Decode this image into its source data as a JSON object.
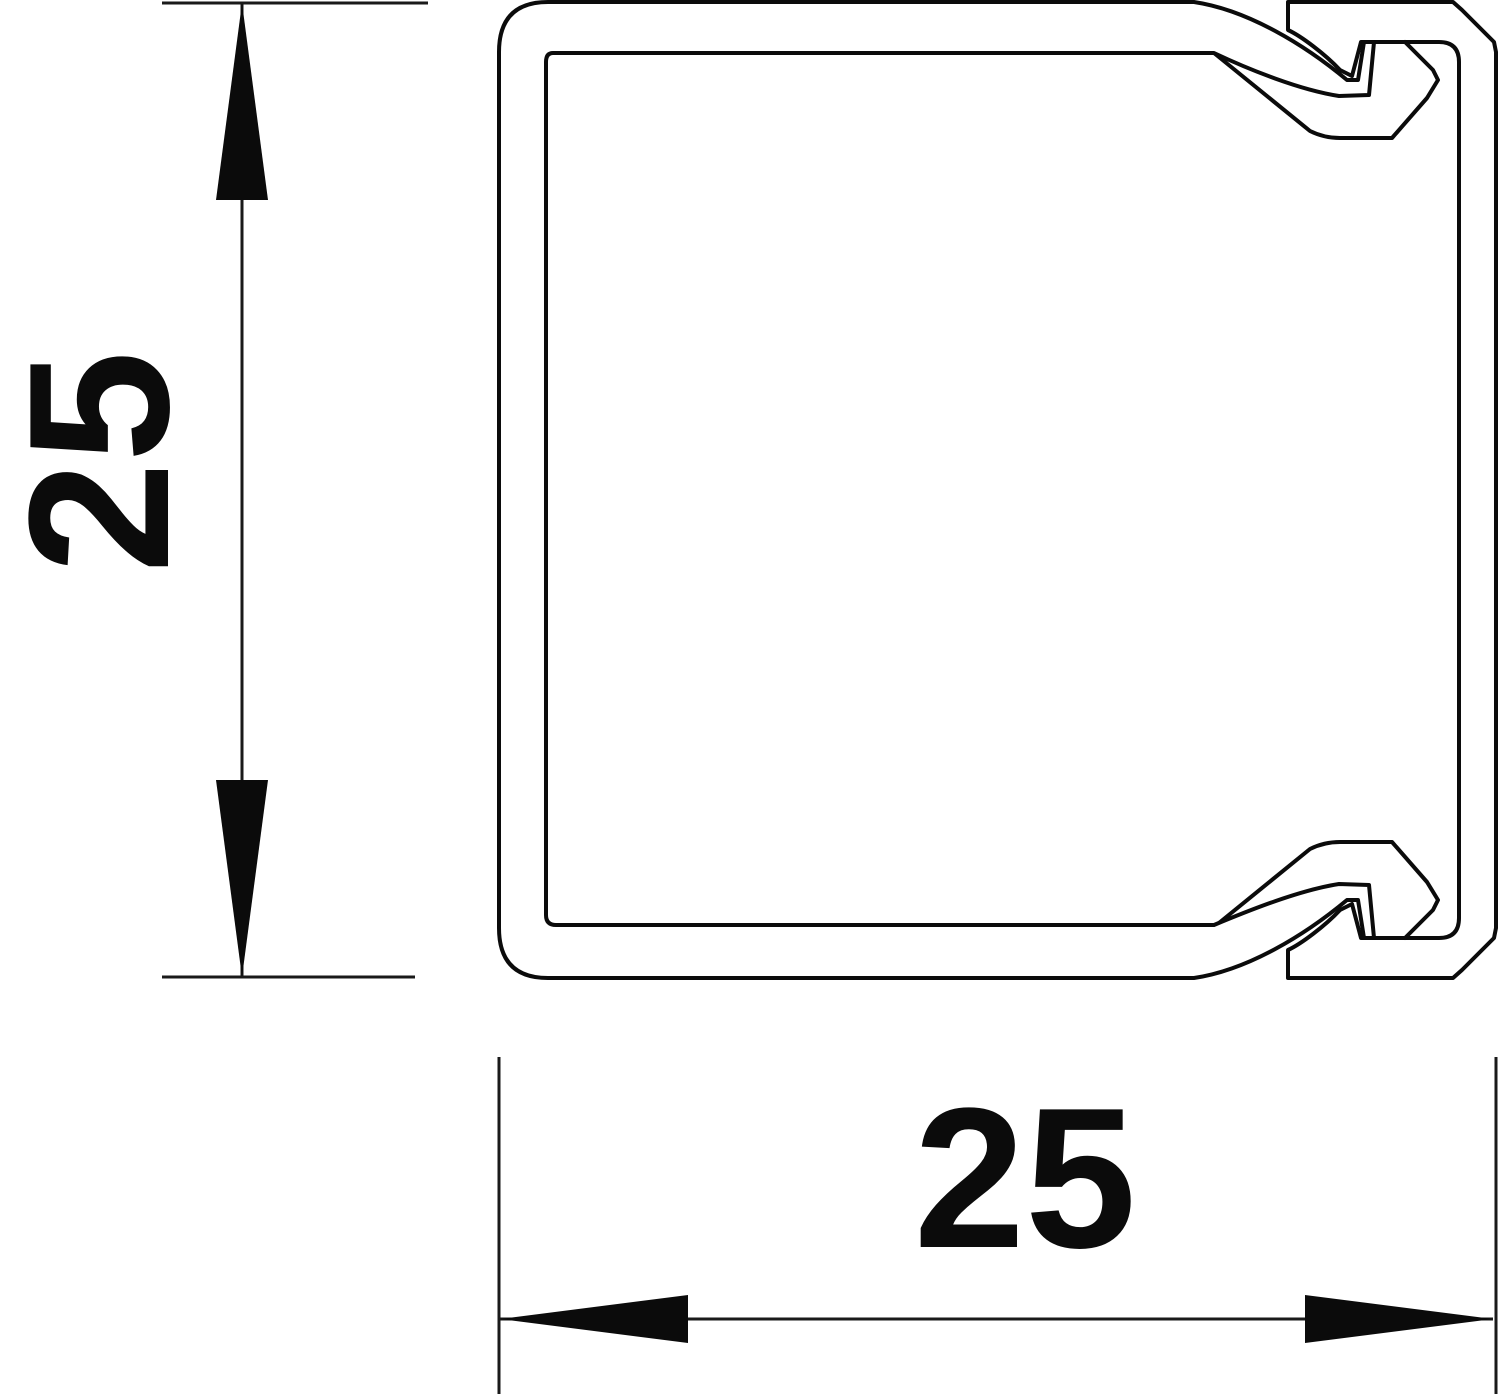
{
  "figure": {
    "type": "technical-cross-section",
    "subject": "square trunking profile with snap-on cover",
    "background_color": "#ffffff",
    "line_color": "#0b0b0b"
  },
  "dimensions": {
    "height": {
      "label": "25"
    },
    "width": {
      "label": "25"
    }
  }
}
